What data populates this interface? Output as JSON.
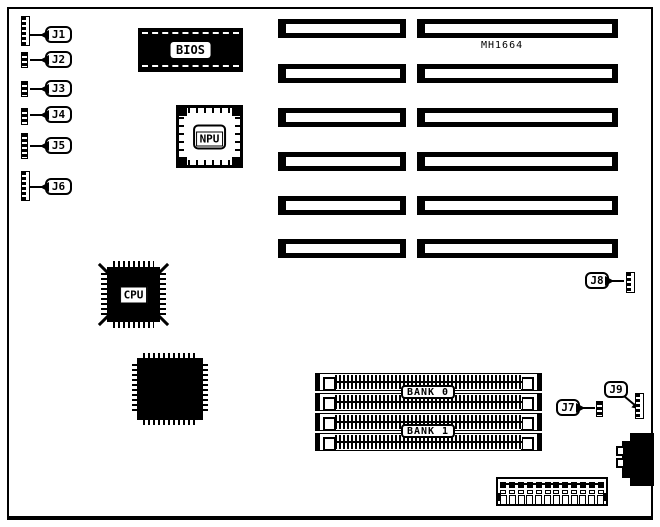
{
  "figure": {
    "model_text": "MH1664",
    "chips": {
      "bios": "BIOS",
      "npu": "NPU",
      "cpu": "CPU"
    },
    "memory": {
      "bank0_label": "BANK 0",
      "bank1_label": "BANK 1",
      "socket_rows": 4
    },
    "connectors": {
      "left": [
        {
          "label": "J1",
          "pins": 6
        },
        {
          "label": "J2",
          "pins": 3
        },
        {
          "label": "J3",
          "pins": 3
        },
        {
          "label": "J4",
          "pins": 3
        },
        {
          "label": "J5",
          "pins": 5
        },
        {
          "label": "J6",
          "pins": 6
        }
      ],
      "right": [
        {
          "label": "J7",
          "pins": 3
        },
        {
          "label": "J8",
          "pins": 3
        },
        {
          "label": "J9",
          "pins": 4
        }
      ]
    },
    "expansion_slots": {
      "rows": 6,
      "columns": 2
    },
    "power_connector": {
      "pins": 12
    },
    "colors": {
      "ink": "#000000",
      "paper": "#ffffff"
    }
  }
}
